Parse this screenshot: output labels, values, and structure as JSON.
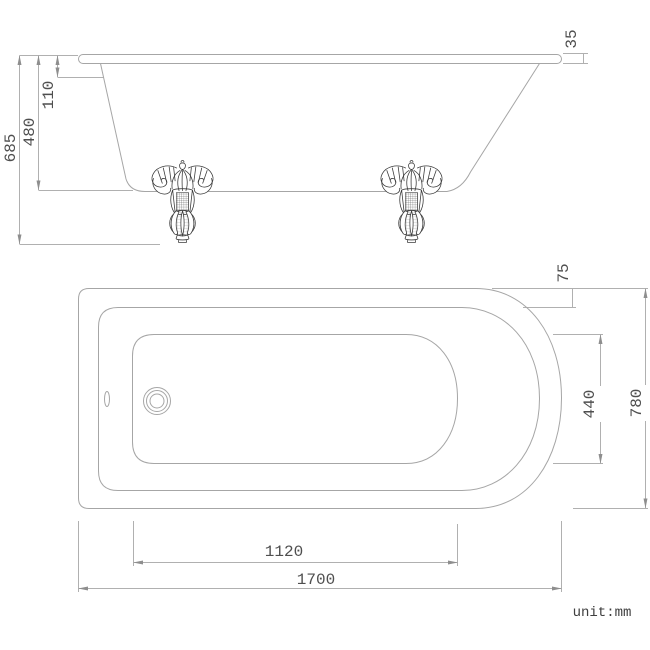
{
  "drawing": {
    "type": "technical-dimension-drawing",
    "subject": "clawfoot-bathtub",
    "views": {
      "side_elevation": "top",
      "plan": "bottom"
    }
  },
  "dims": {
    "overall_height": "685",
    "rim_to_base_height": "480",
    "rim_drop": "110",
    "rim_thickness": "35",
    "deck_width": "75",
    "basin_width": "440",
    "overall_width": "780",
    "base_length": "1120",
    "overall_length": "1700"
  },
  "note": {
    "unit": "unit:mm"
  },
  "colors": {
    "background": "#ffffff",
    "outline": "#a6a6a6",
    "dimension_line": "#b0b0b0",
    "arrow": "#8e8e8e",
    "text": "#4f4f4f",
    "foot_linework": "#3d3d3d"
  }
}
